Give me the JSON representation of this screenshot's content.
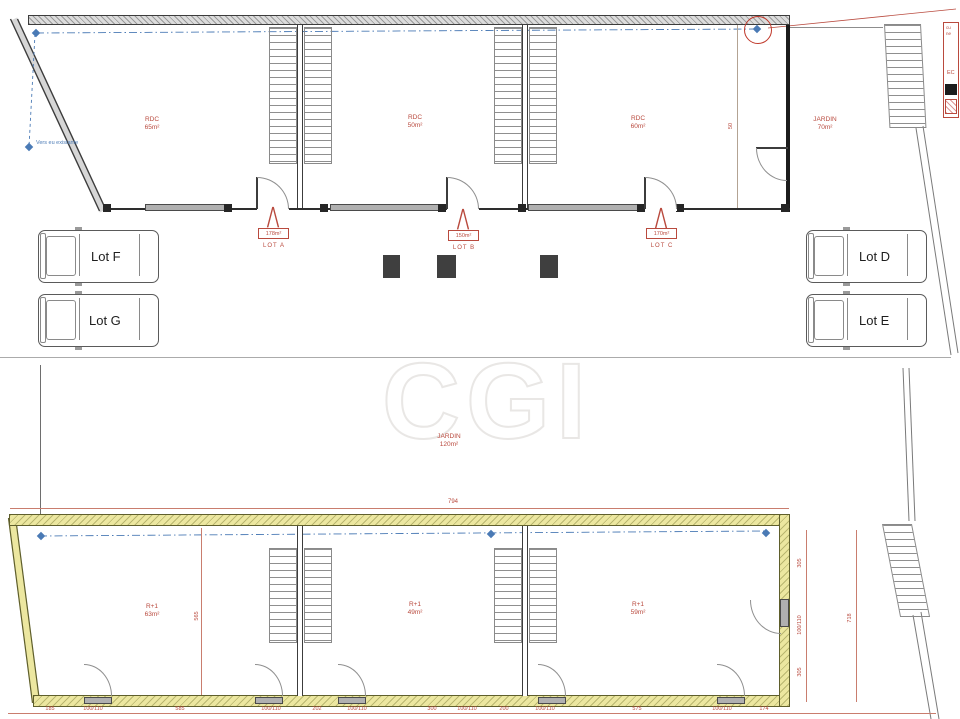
{
  "colors": {
    "annotation_red": "#b94a3e",
    "annotation_blue": "#4a7ab5",
    "wall_yellow": "#ece7a0"
  },
  "watermark": {
    "text": "CGI"
  },
  "annotations": {
    "blue_note": "Vers eu existante"
  },
  "top_plan": {
    "rooms": [
      {
        "line1": "RDC",
        "line2": "65m²"
      },
      {
        "line1": "RDC",
        "line2": "50m²"
      },
      {
        "line1": "RDC",
        "line2": "60m²"
      }
    ],
    "jardin": {
      "line1": "JARDIN",
      "line2": "70m²"
    },
    "dim_width": "50",
    "lots": [
      {
        "area": "178m²",
        "name": "LOT A"
      },
      {
        "area": "150m²",
        "name": "LOT B"
      },
      {
        "area": "170m²",
        "name": "LOT C"
      }
    ]
  },
  "parking": {
    "lots": [
      {
        "label": "Lot F"
      },
      {
        "label": "Lot G"
      },
      {
        "label": "Lot D"
      },
      {
        "label": "Lot E"
      }
    ]
  },
  "garden_between": {
    "line1": "JARDIN",
    "line2": "120m²"
  },
  "bottom_plan": {
    "dim_top": "794",
    "dim_left": "565",
    "rooms": [
      {
        "line1": "R+1",
        "line2": "63m²"
      },
      {
        "line1": "R+1",
        "line2": "49m²"
      },
      {
        "line1": "R+1",
        "line2": "59m²"
      }
    ],
    "dims_right": [
      {
        "t": "305"
      },
      {
        "t": "100/110"
      },
      {
        "t": "305"
      }
    ],
    "dim_right_total": "718",
    "dims_bottom": [
      {
        "t": "185"
      },
      {
        "t": "100/110"
      },
      {
        "t": "585"
      },
      {
        "t": "100/110"
      },
      {
        "t": "202"
      },
      {
        "t": "100/110"
      },
      {
        "t": "300"
      },
      {
        "t": "100/110"
      },
      {
        "t": "200"
      },
      {
        "t": "100/110"
      },
      {
        "t": "575"
      },
      {
        "t": "100/110"
      },
      {
        "t": "174"
      }
    ]
  },
  "legend": {
    "line1": "cu",
    "line2": "ne",
    "line3": "EC"
  }
}
